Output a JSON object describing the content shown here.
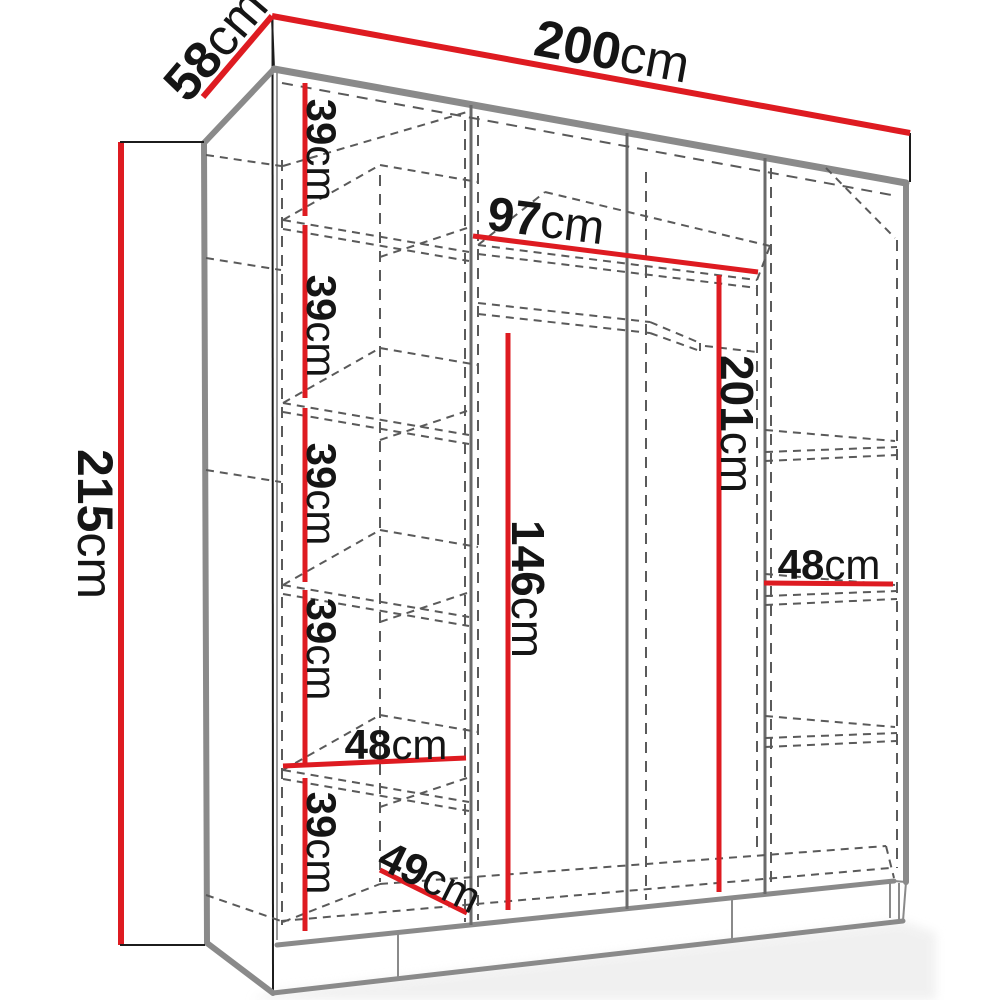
{
  "title": "wardrobe-dimensions-diagram",
  "unit": "cm",
  "colors": {
    "dimension_red": "#de1b21",
    "outline_gray": "#8a8a8a",
    "line_black": "#1c1c1c",
    "dash_gray": "#5a5a5a",
    "text_black": "#151515",
    "background": "#ffffff"
  },
  "dimensions": {
    "width": {
      "num": "200",
      "unit": "cm"
    },
    "depth": {
      "num": "58",
      "unit": "cm"
    },
    "height": {
      "num": "215",
      "unit": "cm"
    },
    "gap1": {
      "num": "39",
      "unit": "cm"
    },
    "gap2": {
      "num": "39",
      "unit": "cm"
    },
    "gap3": {
      "num": "39",
      "unit": "cm"
    },
    "gap4": {
      "num": "39",
      "unit": "cm"
    },
    "gap5": {
      "num": "39",
      "unit": "cm"
    },
    "mid_width": {
      "num": "97",
      "unit": "cm"
    },
    "right_height": {
      "num": "201",
      "unit": "cm"
    },
    "hanging_height": {
      "num": "146",
      "unit": "cm"
    },
    "left_shelf_width": {
      "num": "48",
      "unit": "cm"
    },
    "left_shelf_depth": {
      "num": "49",
      "unit": "cm"
    },
    "right_shelf_width": {
      "num": "48",
      "unit": "cm"
    }
  }
}
